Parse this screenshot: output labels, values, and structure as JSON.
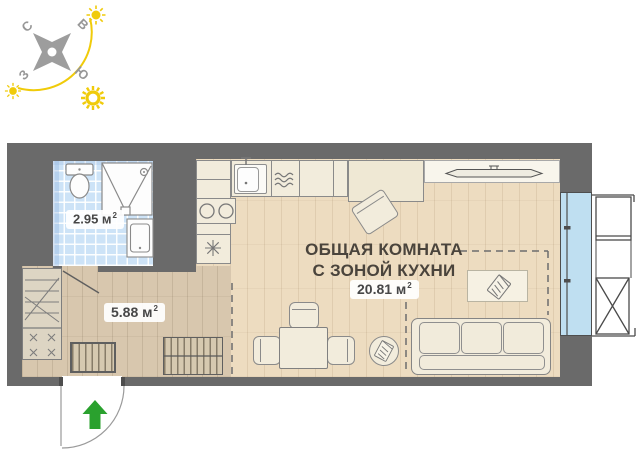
{
  "compass": {
    "north_label": "С",
    "east_label": "В",
    "west_label": "З",
    "south_label": "Ю"
  },
  "rooms": {
    "bathroom": {
      "area": "2.95 м",
      "area_sup": "2"
    },
    "hallway": {
      "area": "5.88 м",
      "area_sup": "2"
    },
    "main_room": {
      "title_line1": "ОБЩАЯ КОМНАТА",
      "title_line2": "С ЗОНОЙ КУХНИ",
      "area": "20.81 м",
      "area_sup": "2"
    }
  },
  "icons": {
    "compass": "compass-rose",
    "suns": "sun-icon",
    "entry": "entry-arrow-icon",
    "fixtures": [
      "toilet-icon",
      "shower-icon",
      "bathroom-sink-icon",
      "kitchen-sink-icon",
      "cooktop-icon",
      "fridge-snowflake-icon",
      "washer-icon",
      "tv-icon",
      "notepad-icon"
    ]
  },
  "colors": {
    "wall": "#6a6a6a",
    "floor-main": "#eddcc0",
    "floor-hall": "#d8c7ae",
    "tile": "#cde3f7",
    "window": "#bfdff1",
    "furniture": "#f2ecdc",
    "outline": "#8a8a8a",
    "text": "#4a443c",
    "green": "#2aa12e",
    "yellow": "#f0cb0a"
  }
}
